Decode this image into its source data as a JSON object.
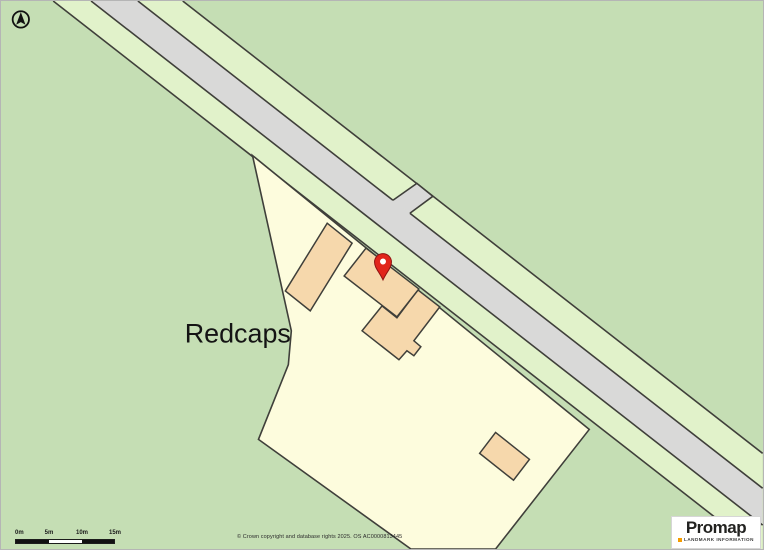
{
  "map": {
    "place_label": "Redcaps",
    "colors": {
      "field": "#c5deb4",
      "verge": "#e1f2ca",
      "road": "#d9d9d8",
      "parcel": "#fdfcdd",
      "building": "#f6d8ac",
      "outline": "#3f3f3a",
      "pin": "#e1251b",
      "pin_hole": "#ffffff"
    }
  },
  "scale_bar": {
    "labels": [
      "0m",
      "5m",
      "10m",
      "15m"
    ]
  },
  "attribution": {
    "copyright": "© Crown copyright and database rights 2025. OS AC0000813445"
  },
  "branding": {
    "name": "Promap",
    "tagline": "LANDMARK INFORMATION",
    "accent": "#f59c00"
  }
}
